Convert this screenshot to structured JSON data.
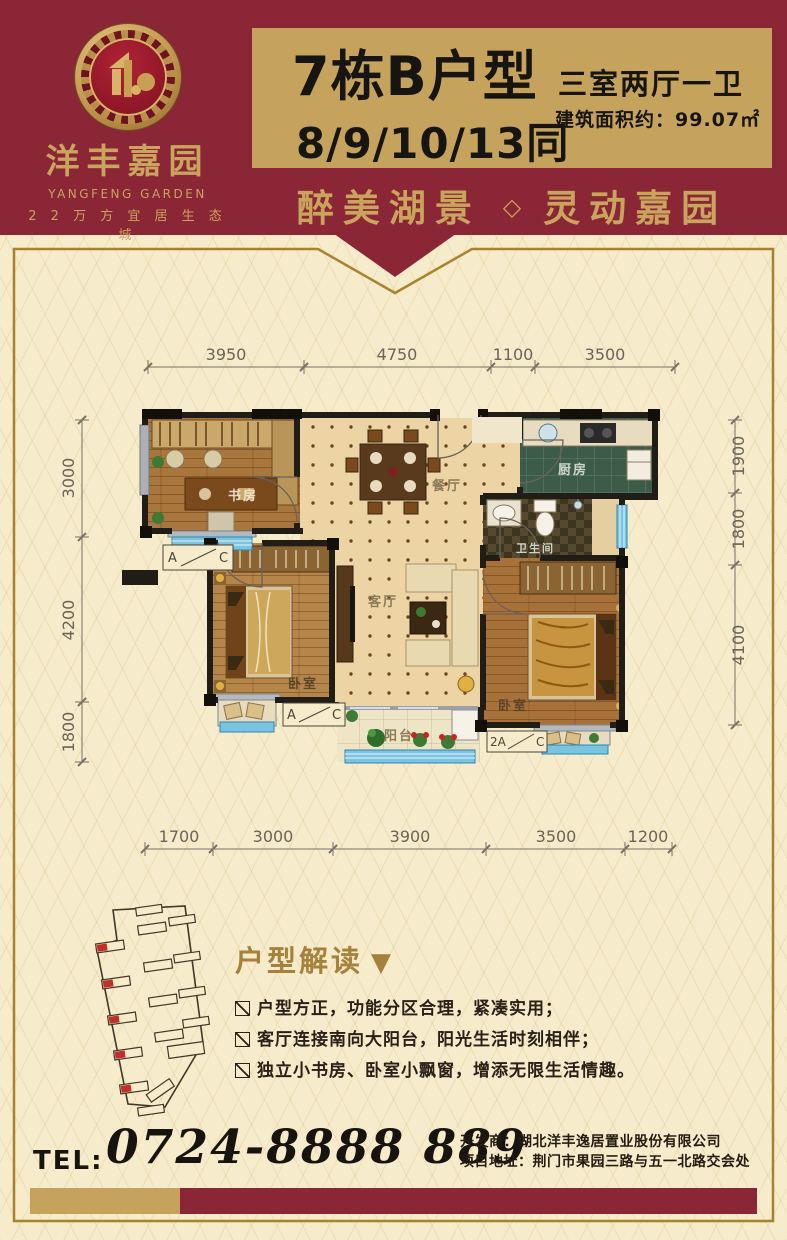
{
  "brand": {
    "name": "洋丰嘉园",
    "name_en": "YANGFENG GARDEN",
    "tagline": "2 2 万 方 宜 居 生 态 城"
  },
  "header": {
    "unit_title": "7栋B户型",
    "unit_note": "8/9/10/13同",
    "layout": "三室两厅一卫",
    "area": "建筑面积约：99.07㎡",
    "slogan_left": "醉美湖景",
    "slogan_divider": "◇",
    "slogan_right": "灵动嘉园"
  },
  "plan": {
    "rooms": {
      "study": "书房",
      "dining": "餐厅",
      "kitchen": "厨房",
      "bath": "卫生间",
      "bedroom_left": "卧室",
      "living": "客厅",
      "bedroom_right": "卧室",
      "balcony": "阳台"
    },
    "dims_top": [
      "3950",
      "4750",
      "1100",
      "3500"
    ],
    "dims_bottom": [
      "1700",
      "3000",
      "3900",
      "3500",
      "1200"
    ],
    "dims_left": [
      "3000",
      "4200",
      "1800"
    ],
    "dims_right": [
      "1900",
      "1800",
      "4100"
    ],
    "markers": {
      "m1_left": "A",
      "m1_right": "C",
      "m2_left": "A",
      "m2_right": "C",
      "m3_left": "2A",
      "m3_right": "C"
    }
  },
  "analysis": {
    "title": "户型解读",
    "marker": "▼",
    "bullets": [
      "户型方正，功能分区合理，紧凑实用；",
      "客厅连接南向大阳台，阳光生活时刻相伴；",
      "独立小书房、卧室小飘窗，增添无限生活情趣。"
    ]
  },
  "contact": {
    "tel_label": "TEL:",
    "tel_number": "0724-8888 889",
    "developer": "开发商：湖北洋丰逸居置业股份有限公司",
    "address": "项目地址：荆门市果园三路与五一北路交会处"
  }
}
